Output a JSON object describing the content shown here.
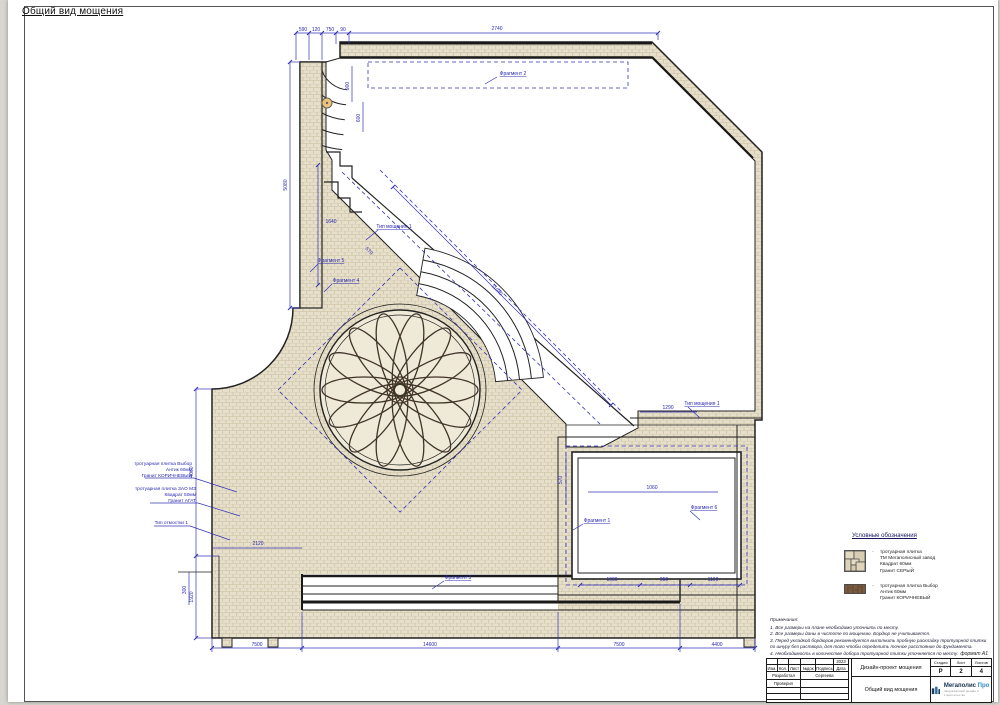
{
  "sheet": {
    "title": "Общий вид мощения",
    "format_label": "формат А1"
  },
  "watermark": {
    "text": "Мегаполис Про"
  },
  "callouts": {
    "c1": {
      "l1": "тротуарная плитка Выбор",
      "l2": "Антик 60мм",
      "l3": "Гранит КОРИЧНЕВЫЙ"
    },
    "c2": {
      "l1": "тротуарная плитка ЗАО МЗ",
      "l2": "Квадрат 50мм",
      "l3": "Гранит АГАТ"
    },
    "c3": {
      "l1": "Тип отмостки 1"
    }
  },
  "labels": {
    "fragment1": "Фрагмент 1",
    "fragment2": "Фрагмент 2",
    "fragment3": "Фрагмент 3",
    "fragment4": "Фрагмент 4",
    "fragment5": "Фрагмент 5",
    "fragment6": "Фрагмент 6",
    "paving_type_top": "Тип мощения 1",
    "paving_type_right": "Тип мощения 1"
  },
  "dims": [
    "590",
    "120",
    "750",
    "90",
    "2740",
    "5080",
    "1640",
    "900",
    "600",
    "11040",
    "4060",
    "1920",
    "2120",
    "300",
    "7500",
    "14600",
    "7500",
    "4400",
    "1290",
    "1060",
    "570",
    "1000",
    "950",
    "1190",
    "570"
  ],
  "legend": {
    "title": "Условные обозначения",
    "items": [
      {
        "lines": [
          "тротуарная плитка",
          "ТМ Мегаполисный завод",
          "Квадрат 60мм",
          "Гранит СЕРЫЙ"
        ]
      },
      {
        "lines": [
          "тротуарная плитка Выбор",
          "Антик 60мм",
          "Гранит КОРИЧНЕВЫЙ"
        ]
      }
    ]
  },
  "notes": {
    "title": "Примечания:",
    "items": [
      "1. Все размеры на плане необходимо уточнить по месту.",
      "2. Все размеры даны в чистоте по мощению. Бордюр не учитывается.",
      "3. Перед укладкой бордюров рекомендуется выполнить пробную раскладку тротуарной плитки по шнуру без раствора, для того чтобы определить точное расстояние до фундамента.",
      "4. Необходимость в количестве добора тротуарной плитки уточняется по месту."
    ]
  },
  "stamp": {
    "cols": [
      "Изм.",
      "Кол.",
      "Лист",
      "№док",
      "Подпись",
      "Дата"
    ],
    "year": "2023",
    "row_dev_label": "Разработал",
    "row_dev_value": "Сергеева",
    "row_check_label": "Проверил",
    "project": "Дизайн-проект мощения",
    "sheet_name": "Общий вид мощения",
    "stage_label": "Стадия",
    "sheet_label": "Лист",
    "sheets_label": "Листов",
    "stage": "Р",
    "sheet_num": "2",
    "sheets_total": "4",
    "logo_name": "Мегаполис",
    "logo_pro": "Про",
    "logo_tagline": "ландшафтный дизайн и строительство"
  },
  "colors": {
    "dim_blue": "#3434b8",
    "paving": "#e6dfca",
    "outline": "#222222"
  }
}
